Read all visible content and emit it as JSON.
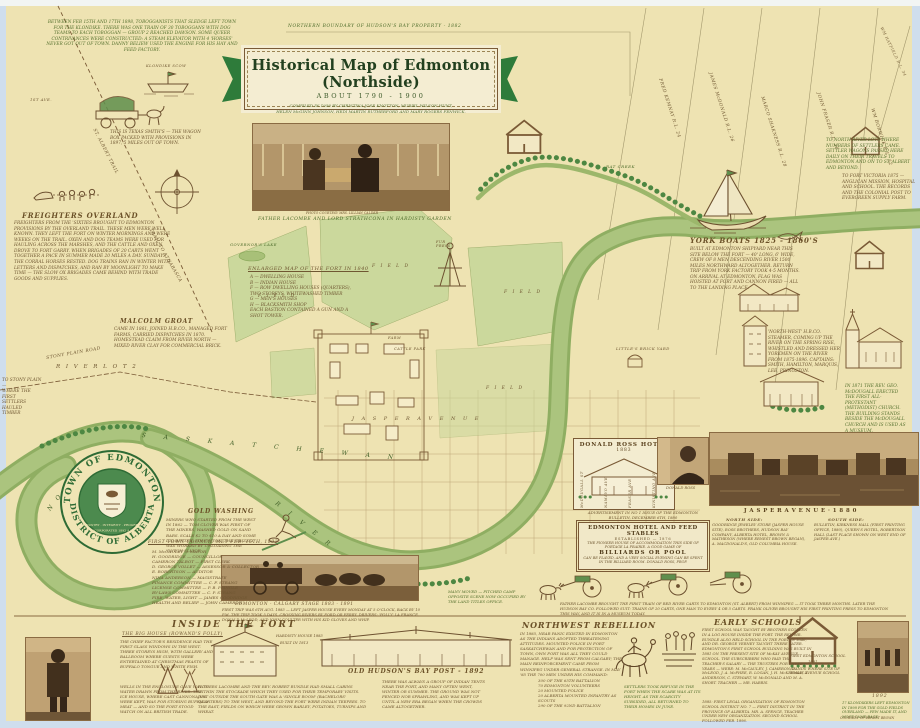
{
  "colors": {
    "paper": "#eee3b2",
    "river": "#9cb76b",
    "field": "#cbd89c",
    "ink_green": "#55702e",
    "ink_brown": "#6f5732",
    "banner_green": "#2e7b3a",
    "sepia": "#b59767"
  },
  "banner": {
    "boundary_note": "NORTHERN BOUNDARY OF HUDSON'S BAY PROPERTY - 1882",
    "title": "Historical Map of Edmonton (Northside)",
    "subtitle": "ABOUT 1790 - 1900",
    "credits1": "COMPILED IN 1958 BY CHRISTINA JOSE KNOTTON, MURIEL WILSON HUNT,",
    "credits2": "HELEN McGINN JOHNSON, HEDI MARTIN RUTHERFORD AND MARY ROGERS FENWICK."
  },
  "topleft": {
    "klondike": "BETWEEN FEB 15TH AND 17TH 1898, TOBOGGANISTS THAT SLEDGE LEFT TOWN FOR THE KLONDIKE. THERE WAS ONE TRAIN OF 30 TOBOGGANS WITH DOG TEAMS TO EACH TOBOGGAN — GROUP 2 REACHED DAWSON. SOME QUEER CONTRIVANCES WERE CONSTRUCTED: A STEAM ELEVATOR WITH 4 'HORSES' NEVER GOT OUT OF TOWN. DANNY BELIEW USED THE ENGINE FOR HIS HAY AND FEED FACTORY.",
    "scow_label": "KLONDIKE SCOW",
    "wagon_note": "THIS IS TEXAS SMITH'S — THE WAGON BOX PACKED WITH PROVISIONS IN 1897, 5 MILES OUT OF TOWN.",
    "freighters_title": "FREIGHTERS OVERLAND",
    "freighters_text": "FREIGHTERS FROM THE 'SIXTIES BROUGHT TO EDMONTON PROVISIONS BY THE OVERLAND TRAIL. THESE MEN WERE WELL KNOWN. THEY LEFT THE FORT ON WINTER MORNINGS AND WERE WEEKS ON THE TRAIL. OXEN AND DOG TEAMS WERE USED FOR HAULING ACROSS THE MARSHES, AND THE CATTLE AND OXEN DROVE TO FORT GARRY. WHEN BRIGADES OF 20 CARTS WENT TOGETHER A PACE IN SUMMER MADE 20 MILES A DAY. SUNDAYS THE CORRAL HORSES RESTED. DOG TRAINS RAN IN WINTER WITH LETTERS AND DISPATCHES, AND RAN BY MOONLIGHT TO MAKE TIME — THE SLOW OX BRIGADES CAME BEHIND WITH TRADE GOODS AND SUPPLIES.",
    "trail1": "ST. ALBERT TRAIL",
    "trail2": "TRAIL TO ATHABASCA",
    "first_ave": "1ST AVE."
  },
  "groat": {
    "title": "MALCOLM GROAT",
    "text": "CAME IN 1861, JOINED H.B.CO., MANAGED FORT FARMS, CARRIED DISPATCHES IN 1870. HOMESTEAD CLAIM FROM RIVER NORTH — MIXED RIVER CLAY FOR COMMERCIAL BRICK.",
    "river_lot": "R I V E R   L O T   2",
    "stony_road": "STONY PLAIN ROAD",
    "to_stony": "TO STONY PLAIN —\nWHERE THE FIRST\nSETTLERS HAULED\nTIMBER"
  },
  "fort": {
    "lake": "GOVERNOR'S LAKE",
    "legend_title": "ENLARGED MAP OF THE FORT IN 1840",
    "legend": "A — DWELLING HOUSE\nB — INDIAN HOUSE\nF — ROW DWELLING HOUSES (QUARTERS),\n      TWO STOREYS, WHITEWASHED TIMBER\nG — MEN'S HOUSES\nH — BLACKSMITH SHOP\nEACH BASTION CONTAINED A GUN AND A\nSHOT TOWER.",
    "field": "F I E L D",
    "farm": "FARM",
    "cattle": "CATTLE PARK",
    "furpress": "FUR PRESS"
  },
  "rivertext": {
    "north": "N  O  R  T  H",
    "sask": "S A S K A T C H E W A N",
    "river": "R  I  V  E  R",
    "creek": "RAT CREEK"
  },
  "lots": {
    "names": [
      "FRED KEMNAY   R.L. 24",
      "JAMES McDONALD   R.L. 26",
      "MARCO SHAKNESS   R.L. 28",
      "JOHN FRASER   R.L. 30",
      "WM BORWICK   R.L. 32"
    ],
    "corner": "WM HATFIELD  R.L. 34",
    "north_note": "TO NORTH RIVER LOTS WHERE NUMBERS OF SETTLERS CAME. SETTLER WAGONS PASSED HERE DAILY ON THEIR TRAVELS TO EDMONTON AND ON TO ST. ALBERT AND BEYOND.",
    "victoria_note": "TO FORT VICTORIA 1875 — ANGLICAN MISSION, HOSPITAL AND SCHOOL. THE RECORDS AND THE COLONIAL POST TO EVERGREEN SUPPLY FARM."
  },
  "york": {
    "title": "YORK BOATS   1825 - 1860'S",
    "text": "BUILT AT EDMONTON SHIPYARD NEAR THIS SITE BELOW THE FORT — 40' LONG, 6' WIDE, CREW OF 8 MEN DESCENDING RIVER 1500 MILES NORTHWARD ALTOGETHER. RETURN TRIP FROM YORK FACTORY TOOK 4-5 MONTHS. ON ARRIVAL AT EDMONTON, FLAG WAS HOISTED AT FORT AND CANNON FIRED — ALL TO THE LANDING PLACE."
  },
  "right": {
    "steamer_note": "'NORTH-WEST' H.B.CO. STEAMER, COMING UP THE RIVER ON THE SPRING RISE, WHISTLED AND DRESSED HER YORKMEN ON THE RIVER FROM 1875-1896. CAPTAINS: SMITH, HAMILTON, MARQUIS, LEE, PRINGSTON.",
    "church_note": "IN 1871 THE REV. GEO. McDOUGALL ERECTED THE FIRST ALL-PROTESTANT (METHODIST) CHURCH. THE BUILDING STANDS BESIDE THE McDOUGALL CHURCH AND IS USED AS A MUSEUM.",
    "brickyard": "LITTLE'S BRICK YARD"
  },
  "streets": {
    "jasper": "J A S P E R    A V E N U E",
    "names": [
      "McDOUGALL ST",
      "NAMAYO AVE",
      "FRASER AVE",
      "KINISTINO AVE"
    ]
  },
  "crest": {
    "top": "TOWN OF EDMONTON",
    "bottom": "DISTRICT OF ALBERTA",
    "motto": "INDUSTRY · INTEGRITY · PROGRESS",
    "inc": "INCORPORATED 1892 A.D."
  },
  "council": {
    "title": "FIRST TOWN COUNCIL MET FEB. 15TH, 1892",
    "list": "M. McCAULEY — MAYOR\nH. GOODRIDGE — COUNCILLOR\nCAMERON TALBOT — FIRST CLERK\nD. GEORGE VOLLET — ASSESSOR & COLLECTOR\nE. ROBERTSON — AUDITOR\nNINA ANDERSON — MAGISTRATE\nFINANCE COMMITTEE — C. F. STRANG\nLICENSE COMMITTEE — P. B. PRINGLE\nBY-LAWS COMMITTEE — C. P. STRANG\nFIRE, WATER, LIGHT — JAMES GOODRIDGE\nHEALTH AND RELIEF — JOHN CAMERON"
  },
  "gold": {
    "title": "GOLD WASHING",
    "text": "MINERS WHO STARTED FROM THE WEST IN 1862 — TOM CLOVER WAS FIRST OF THE MINERS, WASHED GOLD ON SAND BARS. SCALE $2 TO $10 A DAY AND SOME DID BETTER. EDMONTON: THE 'GRIZZLY' WAS WORKED BY UNLOADING THE 'DUTCH SLUICE'."
  },
  "stage": {
    "title": "EDMONTON - CALGARY STAGE   1883 - 1891",
    "text": "FIRST TRIP WAS 6TH AUG. 1883 — LEFT JASPER HOUSE EVERY MONDAY AT 5 O'CLOCK, BACK BY 10 P.M. THE TRIP TOOK 5 DAYS, CROSSING RIVERS BY FORD OR FERRY. DRIVERS: 'POLLY' LA FRANCE, DONALD McLEOD, AND JOHN COULTER WITH HIS KID GLOVES AND WHIP."
  },
  "ross": {
    "box_title": "DONALD ROSS HOTEL",
    "box_year": "1883",
    "portrait_caption": "DONALD ROSS",
    "ad_intro": "ADVERTISEMENT IN NO 1 ISSUE OF THE EDMONTON BULLETIN, DECEMBER 6TH, 1880",
    "ad_title": "EDMONTON HOTEL AND FEED STABLES",
    "ad_est": "ESTABLISHED — 1876",
    "ad_t1": "THE PIONEER HOUSE OF ACCOMMODATION THIS SIDE OF PORTAGE LA PRAIRIE. A GOOD GAME OF",
    "ad_big": "BILLIARDS OR POOL",
    "ad_t2": "CAN BE PLAYED, AND A VERY SOCIAL EVENING CAN BE SPENT IN THE BILLIARD ROOM.  DONALD ROSS, PROP."
  },
  "jasper1880": {
    "title": "J A S P E R   A V E N U E   · 1 8 8 0",
    "north_title": "NORTH SIDE:",
    "north_text": "GOODRIDGE JEWELRY STORE (JASPER HOUSE SITE), ROSS BROTHERS, HUDSON BAY COMPANY, ALBERTA HOTEL, BROWN & MATHESON (WHERE ERNEST BROWN BEGAN), A. MACDONALD'S, OLD COLUMBIA HOUSE.",
    "south_title": "SOUTH SIDE:",
    "south_text": "BULLETIN, KIRKNESS HALL (FIRST PRINTING OFFICE, 1880), QUEEN'S HOTEL, ROBERTSON HALL (LAST PLACE SHOWN ON WEST END OF JASPER AVE.)"
  },
  "flats": {
    "camp_note": "MANY MOVED — PITCHED CAMP OPPOSITE SCENE NOW OCCUPIED BY THE LAND TITLES OFFICE.",
    "carts_note": "FATHER LACOMBE BROUGHT THE FIRST TRAIN OF RED RIVER CARTS TO EDMONTON (ST. ALBERT) FROM WINNIPEG — IT TOOK THREE MONTHS. LATER THE HUDSON BAY CO. FOLLOWED SUIT: TRAINS OF 20 CARTS, ONE MAN TO EVERY 4 OR 5 CARTS. FRANK OLIVER BROUGHT HIS FIRST PRINTING PRESS TO EDMONTON THIS WAY, AND IT IS IN A MUSEUM TODAY."
  },
  "photos": {
    "lacombe_credit": "PHOTO COURTESY MRS. LILLIAN CALDER",
    "lacombe_caption": "FATHER LACOMBE AND LORD STRATHCONA IN HARDISTY GARDEN"
  },
  "bottom": {
    "fort": {
      "title": "INSIDE THE FORT",
      "sub": "THE BIG HOUSE (ROWAND'S FOLLY)",
      "t1": "THE CHIEF FACTOR'S RESIDENCE HAD THE FIRST GLASS WINDOWS IN THE WEST. THREE STOREYS HIGH, WITH GALLERY AND BALLROOM WHERE GUESTS WERE ENTERTAINED AT CHRISTMAS FEASTS OF BUFFALO TONGUE AND WHITE FISH.",
      "t2": "WELLS IN THE ENCLOSURE GAVE WAY TO WATER DRAWN FROM THE RIVER. THE ICE HOUSE, WHERE CAST CANNONADES WERE KEPT, WAS FOR STORING BUFFALO MEAT — AND SO THE FORT STOOD WATCH ON ALL BRITISH TRADE.",
      "cap1": "HARDISTY HOUSE 1883",
      "cap2": "BUILT IN 1813",
      "t3": "FATHERS LACOMBE AND THE REV. ROBERT RUNDLE HAD SMALL CABINS WITHIN THE STOCKADE WHICH THEY USED FOR THEIR TEMPORARY VISITS. JUST OUTSIDE THE SOUTH GATE WAS A 'SINGLE ROOM' (BACHELORS' QUARTERS) TO THE WEST, AND BEYOND THE FORT WERE INDIAN TEEPEES. TO THE EAST, FIELDS ON WHICH WERE GROWN BARLEY, POTATOES, TURNIPS AND WHEAT."
    },
    "hbc": {
      "title": "OLD HUDSON'S BAY POST  - 1892",
      "text": "THERE WAS ALWAYS A GROUP OF INDIAN TENTS NEAR THE FORT, AND MANY OFTEN WENT, WINTER OR SUMMER. THE GROUND WAS NOT FENCED NOR SPRAWLING, AND WAS KEPT UP UNTIL A NEW ERA BEGAN WHEN THE CROWDS CAME ALTOGETHER."
    },
    "reb": {
      "title": "NORTHWEST REBELLION",
      "text": "IN 1885, NEAR PANIC EXISTED IN EDMONTON AS THE INDIANS ADOPTED THREATENING ATTITUDES. MOUNTED POLICE IN FORT SASKATCHEWAN AND FOR PROTECTION OF TOWN, OWN FORT WAS ALL THEY COULD MANAGE. HELP WAS SENT FROM CALGARY; THE MAIN REINFORCEMENT CAME FROM WINNIPEG UNDER GENERAL STRANGE. IN MAY '85 THE 700 MEN UNDER HIS COMMAND:",
      "list": "300 OF THE 65TH BATTALION\n70 EDMONTON VOLUNTEERS\n20 MOUNTED POLICE\n20 ALBERTA MOUNTED INFANTRY AS SCOUTS\n290 OF THE 92ND BATTALION",
      "refuge": "SETTLERS TOOK REFUGE IN THE FORT WHEN THE SCARE WAS AT ITS HEIGHT. AS THE SCARCITY SUBSIDED, ALL RETURNED TO THEIR HOMES IN JUNE."
    },
    "schools": {
      "title": "EARLY SCHOOLS",
      "t1": "FIRST SCHOOL WAS TAUGHT BY BROTHER SCOLLEN IN A LOG HOUSE INSIDE THE FORT. THE REV. MR. RUNDLE ALSO HELD SCHOOL IN THE FORT IN 1846, AND DR. GEORGE VERNEY TAUGHT THERE LATER. EDMONTON'S FIRST SCHOOL BUILDING WAS BUILT IN 1881 ON THE PRESENT SITE OF McKAY AVENUE SCHOOL. THE SUBSCRIBERS WHO PAID THE TEACHER'S SALARY — THE TRUSTEES FOR THREE YEARS — WERE: M. McCAULEY, J. CAMERON, D. McLEOD, J. A. McPHEE, R. LOGAN, J. H. McKERNAN, T. ANDERSON, C. STEWART, W. McDONALD AND M. A. SHORT.  TEACHER — MR. HARRIS.",
      "t2": "1885: FIRST LEGAL ORGANIZATION OF EDMONTON SCHOOL DISTRICT NO. 7 — FIRST DISTRICT IN THE PROVINCE OF ALBERTA. MR. A. SPENCE, TEACHER UNDER NEW ORGANIZATION. SECOND SCHOOL FOLLOWED FEB. 1896.",
      "cap1": "FIRST EDMONTON SCHOOL",
      "cap2": "1881",
      "cap3": "STANDS WHERE SITE OF McKAY AVENUE SCHOOL",
      "year": "1892",
      "klondike": "17 KLONDIKERS LEFT EDMONTON IN 1898 FOR THE GOLD FIELDS OVERLAND — FEW MADE IT, AND MOST CAME BACK.",
      "credit": "COURTESY OF ERNEST BROWN"
    }
  }
}
